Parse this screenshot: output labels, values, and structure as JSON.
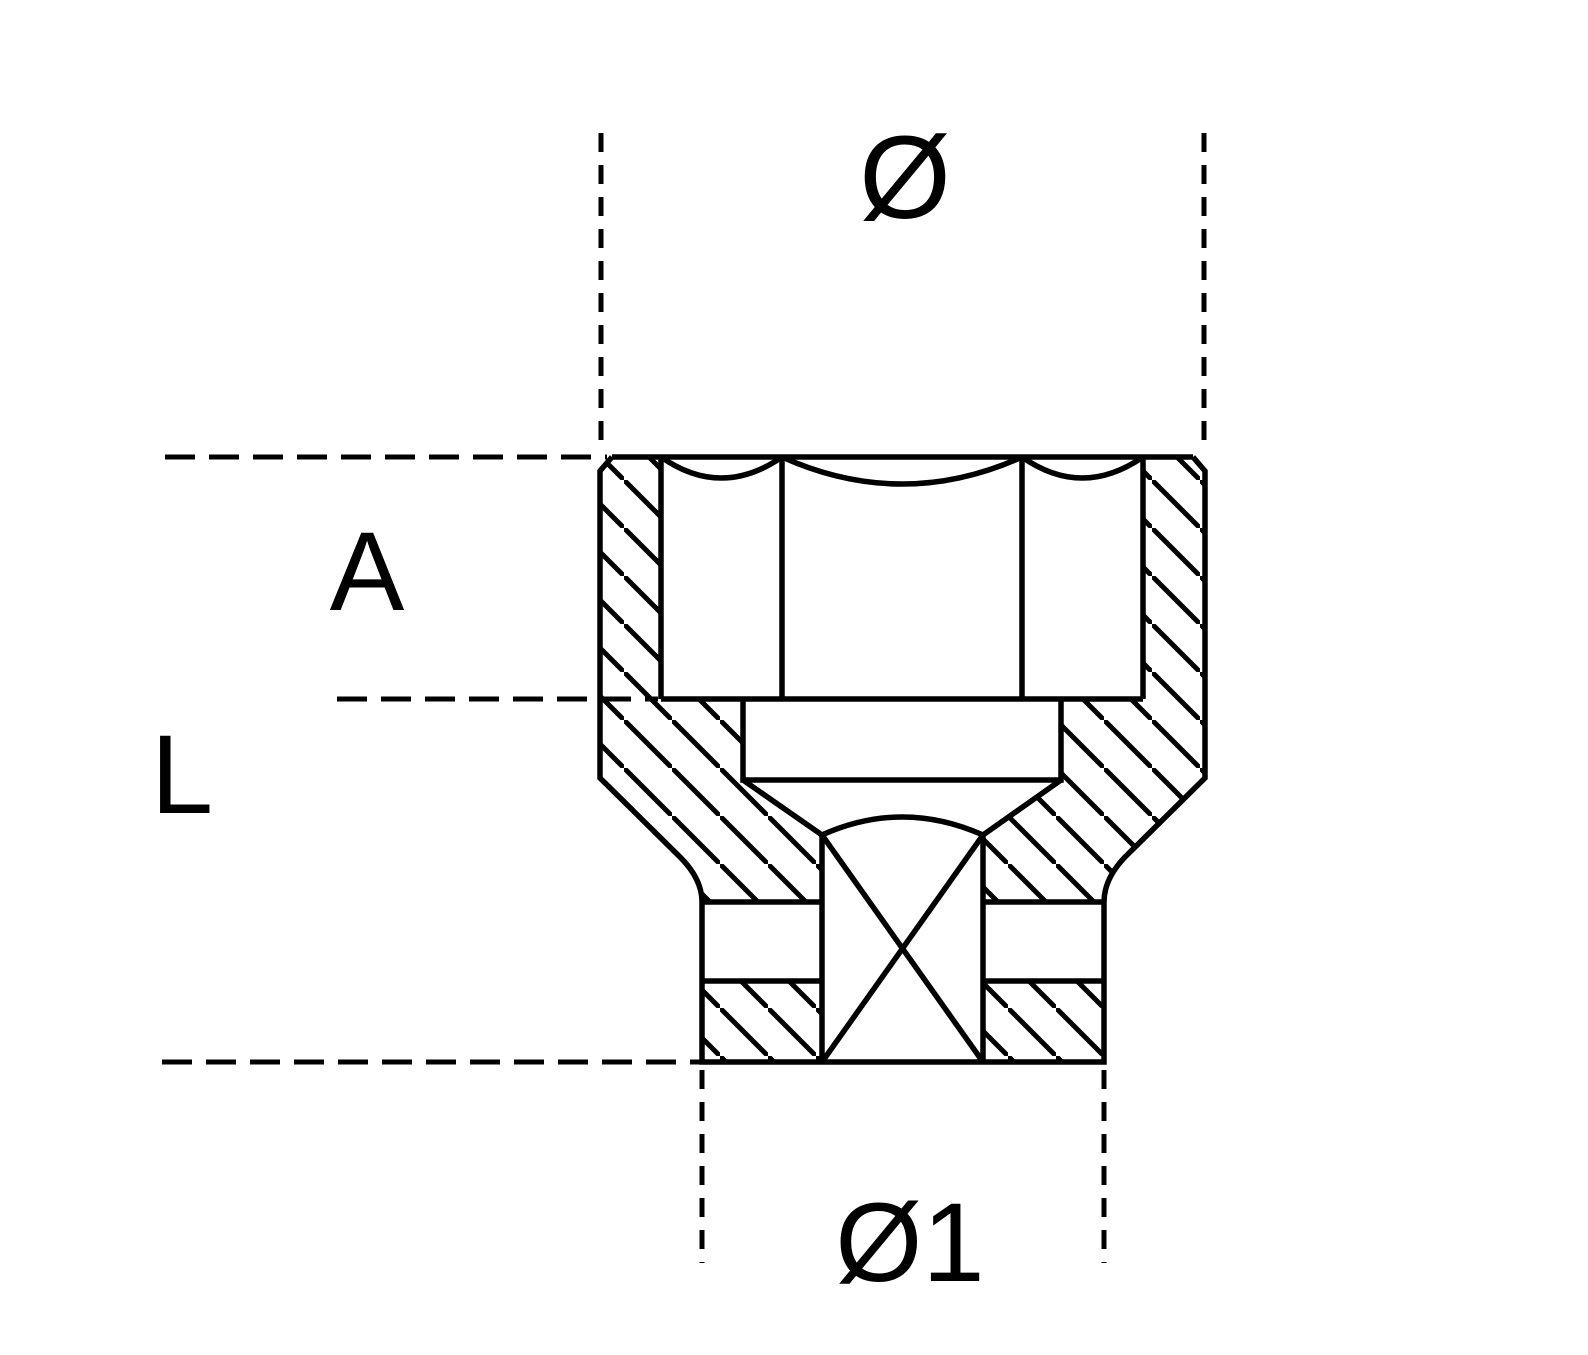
{
  "drawing": {
    "type": "technical-drawing",
    "subject": "socket-wrench-cross-section",
    "dimension_labels": {
      "top_diameter": "Ø",
      "socket_depth": "A",
      "overall_length": "L",
      "drive_side_diameter": "Ø1"
    },
    "colors": {
      "line": "#000000",
      "background": "#ffffff"
    }
  }
}
